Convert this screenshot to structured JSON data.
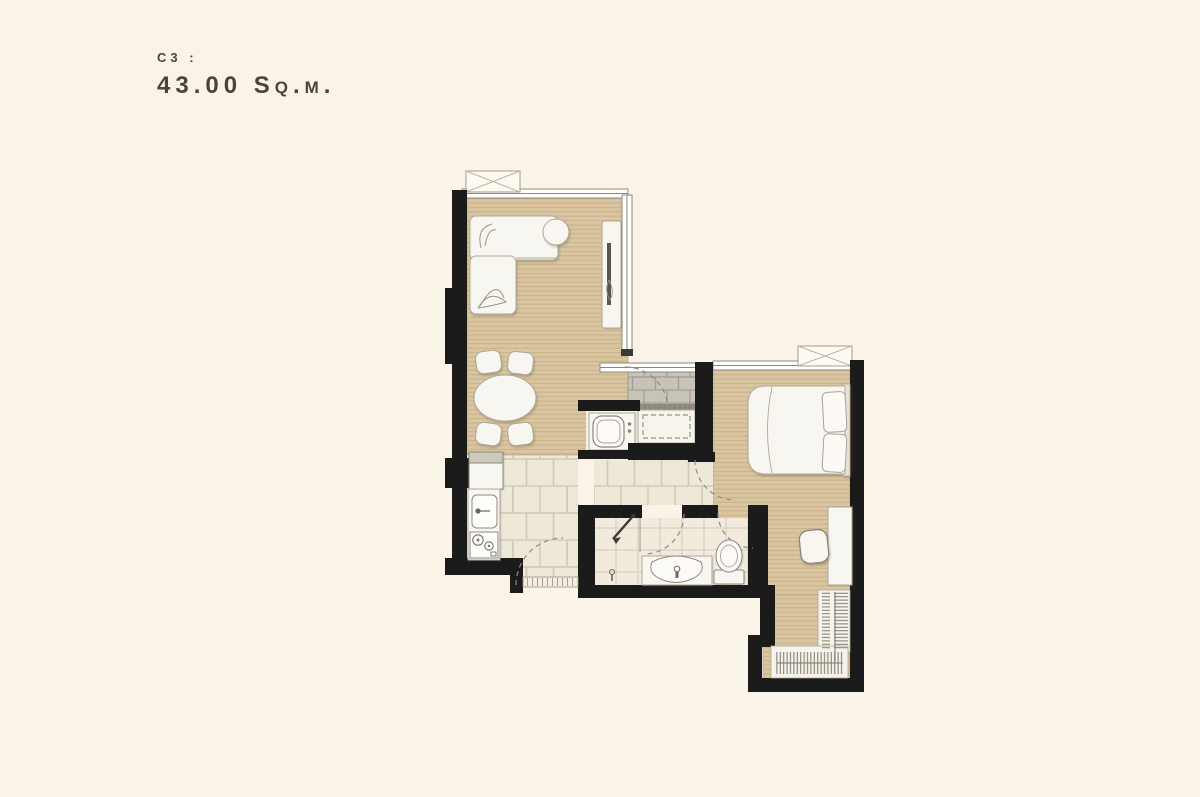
{
  "page": {
    "background_color": "#faf3e7"
  },
  "header": {
    "unit_code": "C3 :",
    "area_label": "43.00 Sq.m."
  },
  "palette": {
    "wall": "#1b1b1b",
    "wood_floor": "#d9c6a1",
    "wood_stripe": "#c9b389",
    "tile_floor": "#eee8d8",
    "tile_joint": "#d2c9b2",
    "bath_tile": "#f0ebdd",
    "balcony_brick": "#c7c3b9",
    "brick_joint": "#a39d91",
    "furniture_fill": "#f8f6f0",
    "furniture_stroke": "#b0a89a",
    "text_color": "#4e4339",
    "background_color": "#faf3e7"
  }
}
